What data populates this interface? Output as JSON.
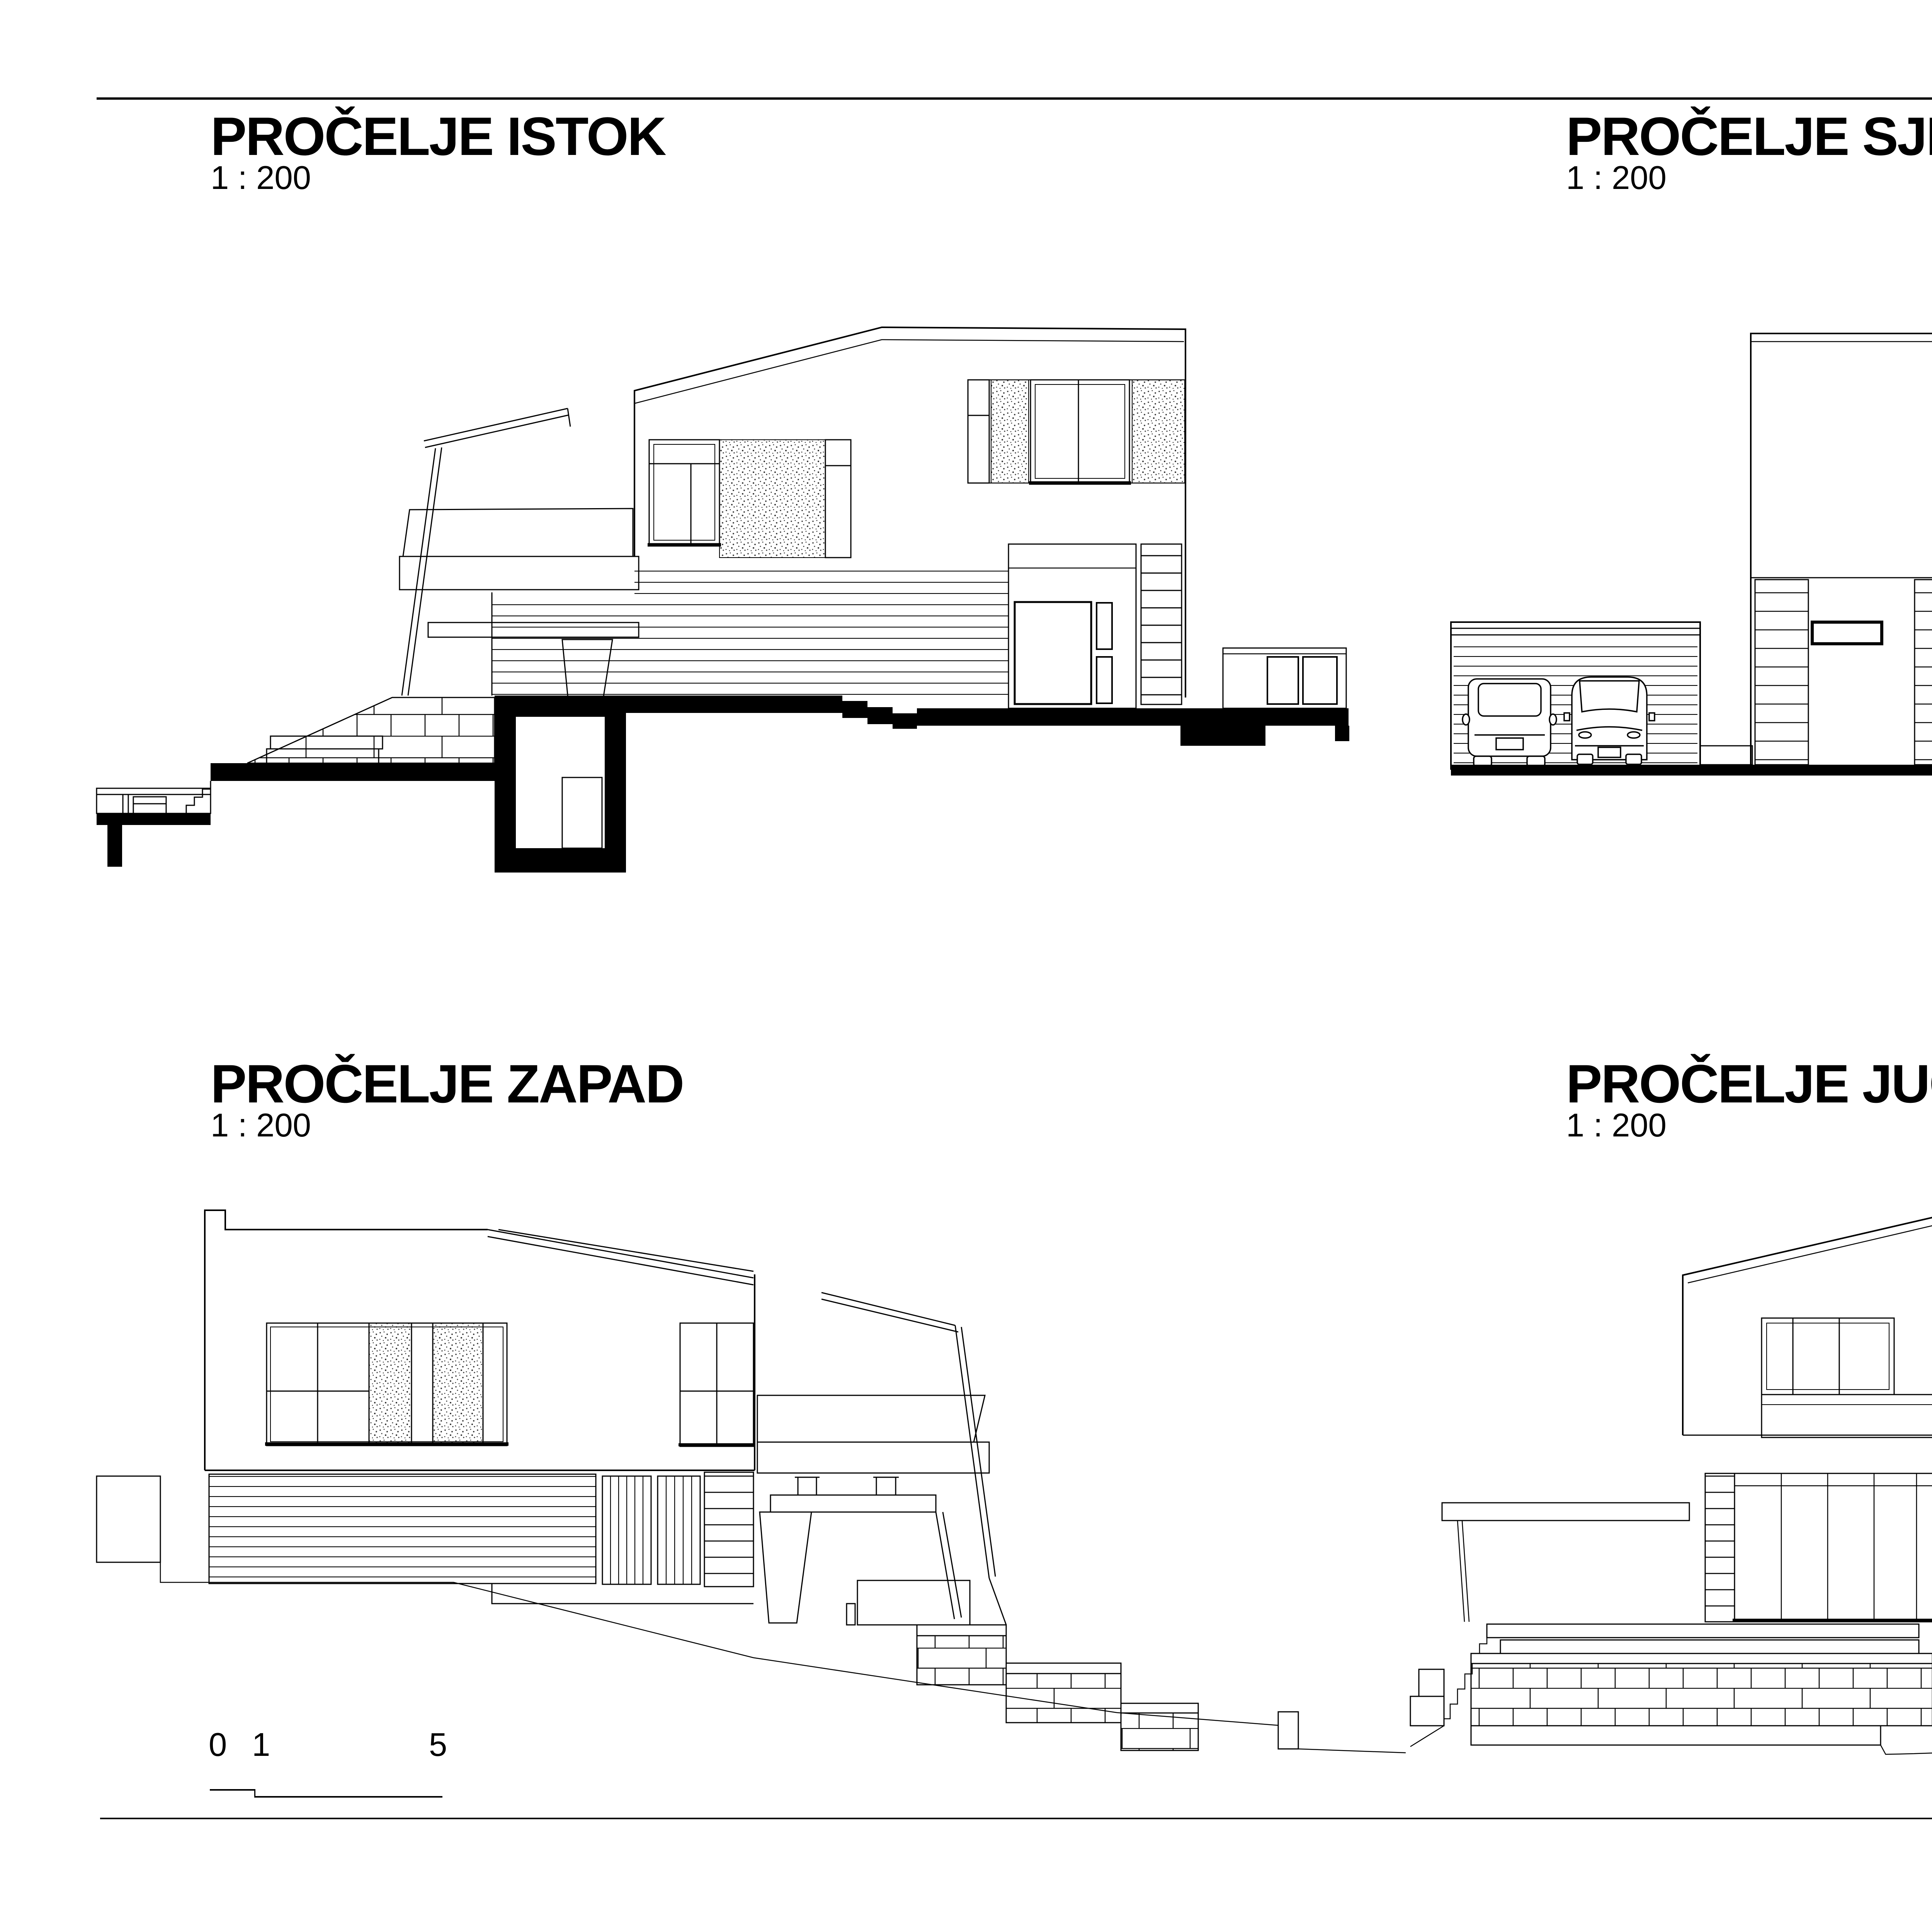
{
  "sheet": {
    "background": "#ffffff",
    "ink": "#000000"
  },
  "panels": [
    {
      "id": "east",
      "title": "PROČELJE ISTOK",
      "scale_label": "1 : 200"
    },
    {
      "id": "north",
      "title": "PROČELJE SJEVER",
      "scale_label": "1 : 200"
    },
    {
      "id": "west",
      "title": "PROČELJE ZAPAD",
      "scale_label": "1 : 200"
    },
    {
      "id": "south",
      "title": "PROČELJE JUG",
      "scale_label": "1 : 200"
    }
  ],
  "scale_bar": {
    "labels": [
      "0",
      "1",
      "5"
    ]
  }
}
